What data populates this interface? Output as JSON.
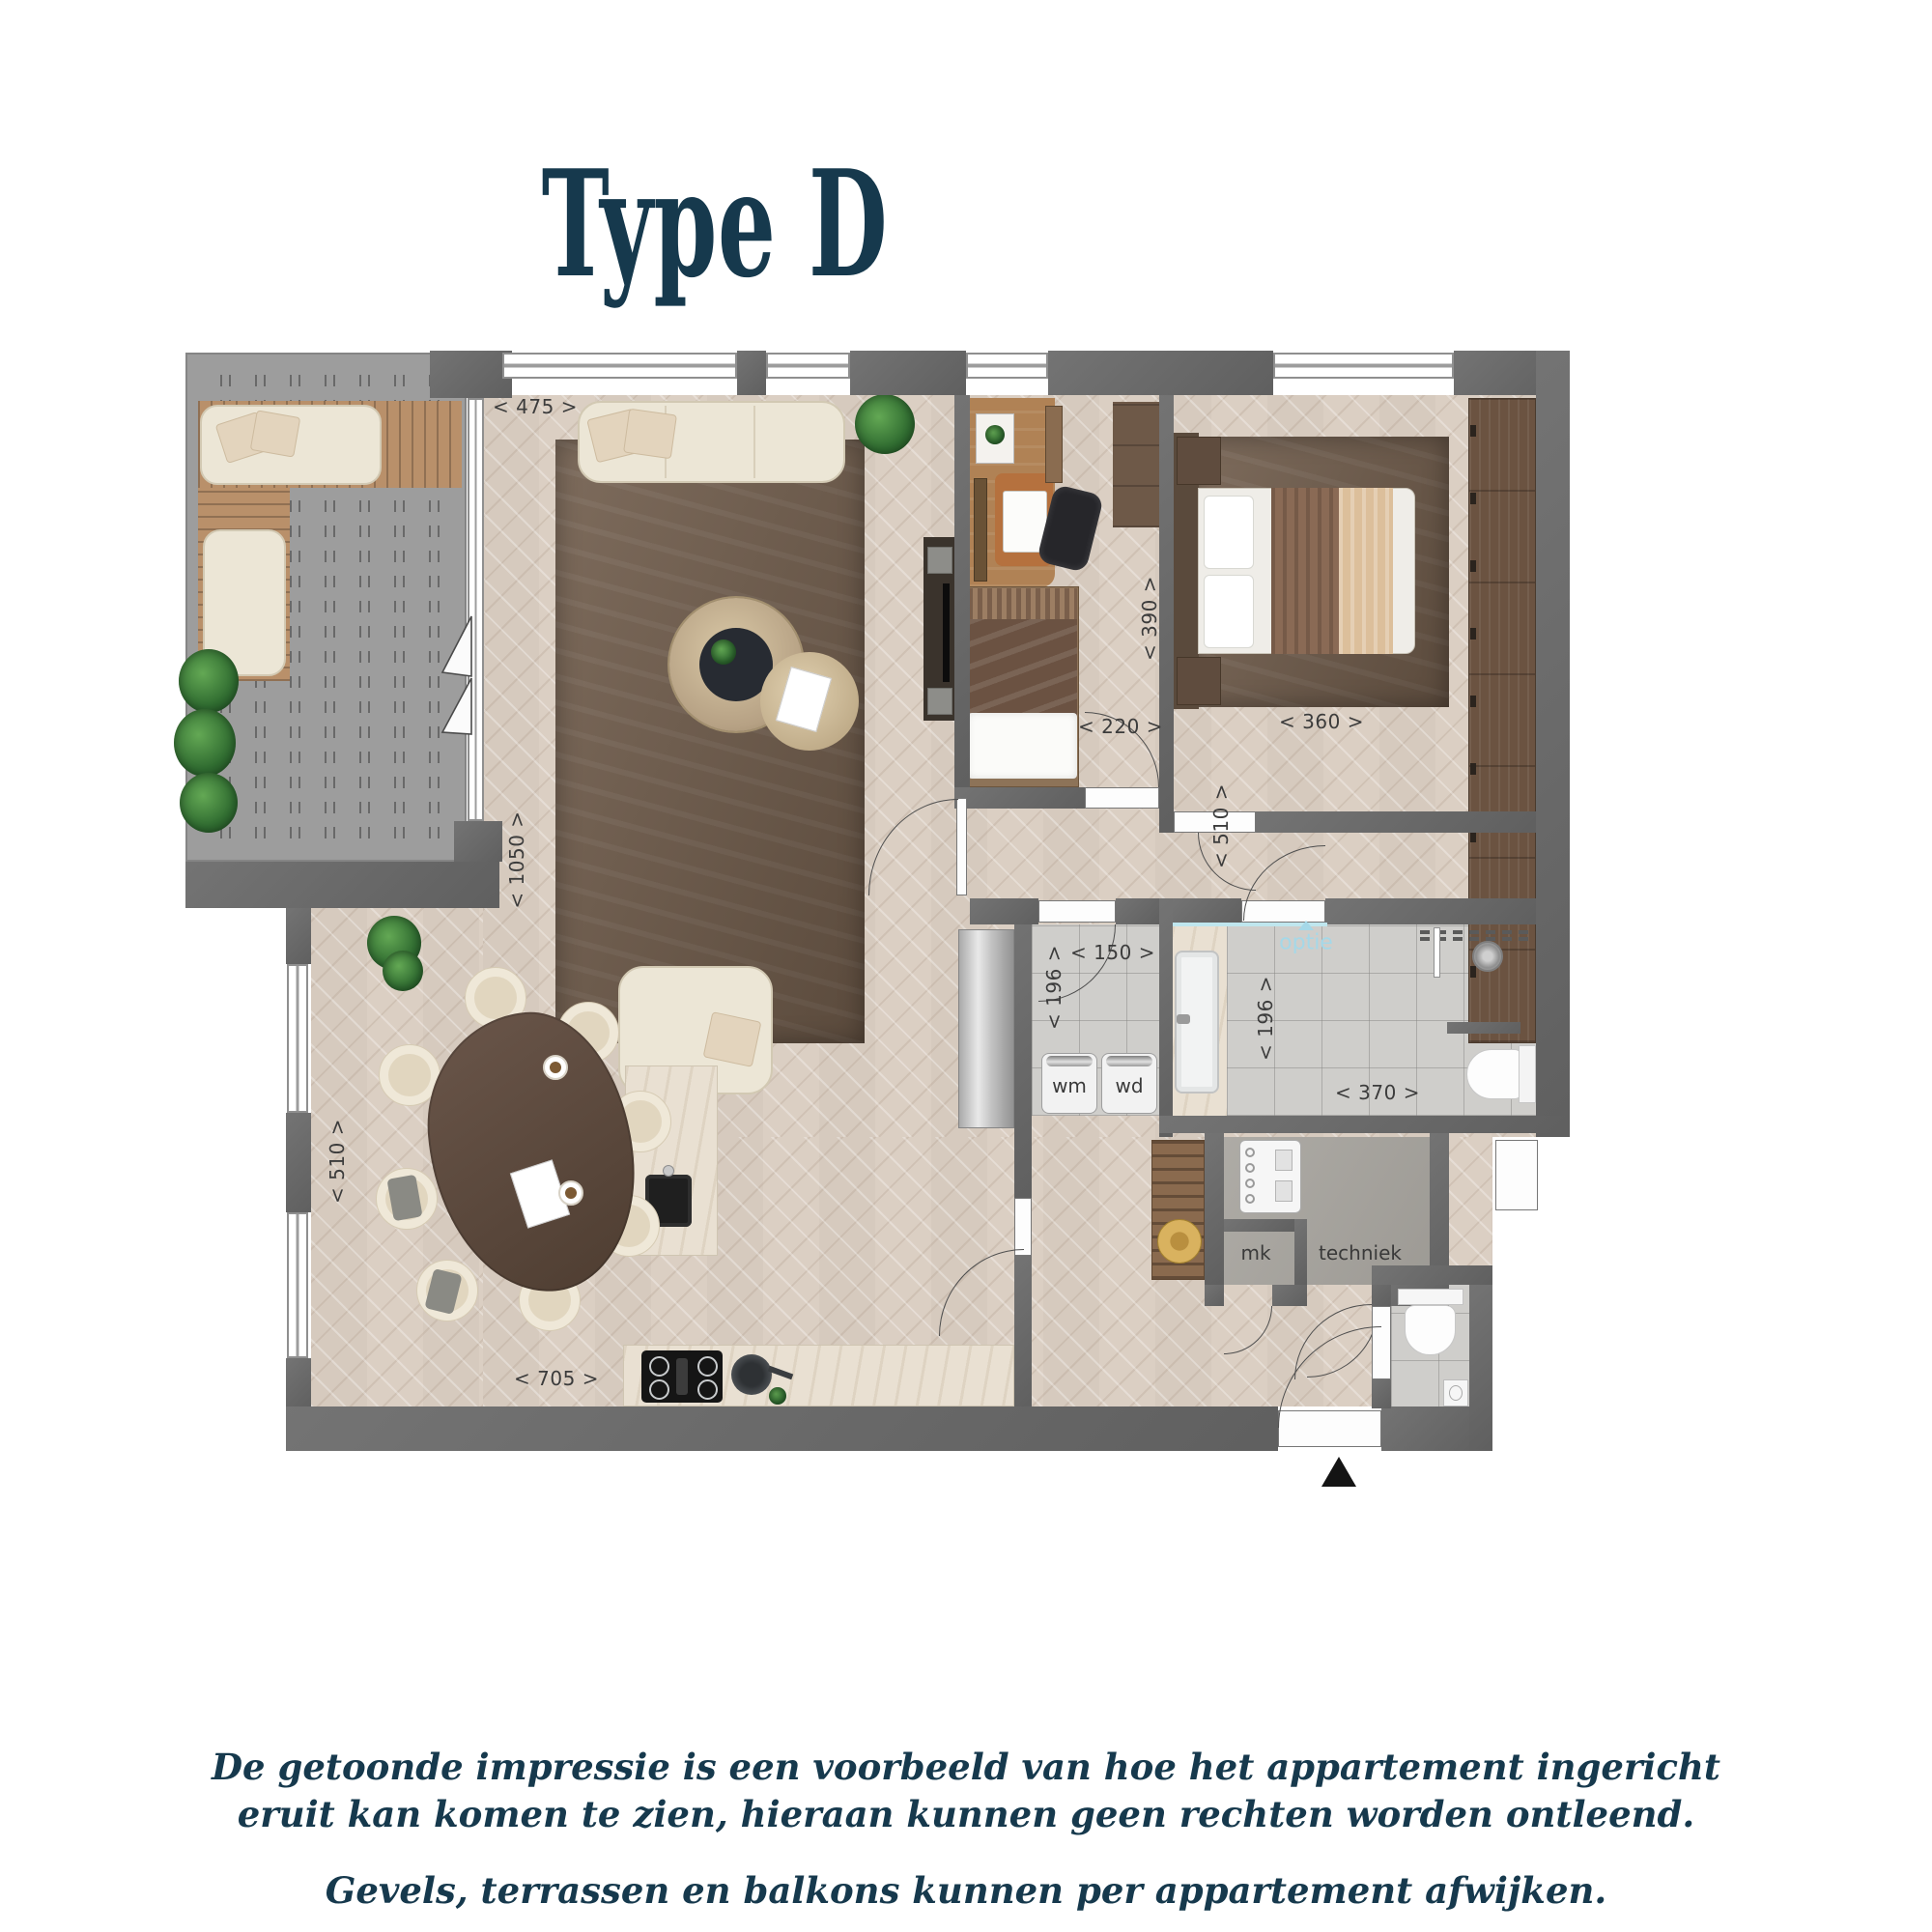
{
  "title": "Type D",
  "footer": {
    "line1": "De getoonde impressie is een voorbeeld van hoe het appartement ingericht eruit kan komen te zien, hieraan kunnen geen rechten worden ontleend.",
    "line2": "Gevels, terrassen en balkons kunnen per appartement afwijken."
  },
  "plan": {
    "dims": {
      "living_width": "< 475 >",
      "living_height": "< 1050 >",
      "study_height": "< 390 >",
      "study_width": "< 220 >",
      "bedroom_width": "< 360 >",
      "bedroom_height": "< 510 >",
      "laundry_width": "< 150 >",
      "laundry_height": "< 196 >",
      "bath_height": "< 196 >",
      "bath_width": "< 370 >",
      "dining_height": "< 510 >",
      "kitchen_width": "< 705 >"
    },
    "labels": {
      "wm": "wm",
      "wd": "wd",
      "optie": "optie",
      "mk": "mk",
      "techniek": "techniek"
    }
  },
  "colors": {
    "accent_text": "#16394d",
    "dim_text": "#3c3c3c",
    "optie_text": "#a5d8e8",
    "wall": "#696969"
  }
}
